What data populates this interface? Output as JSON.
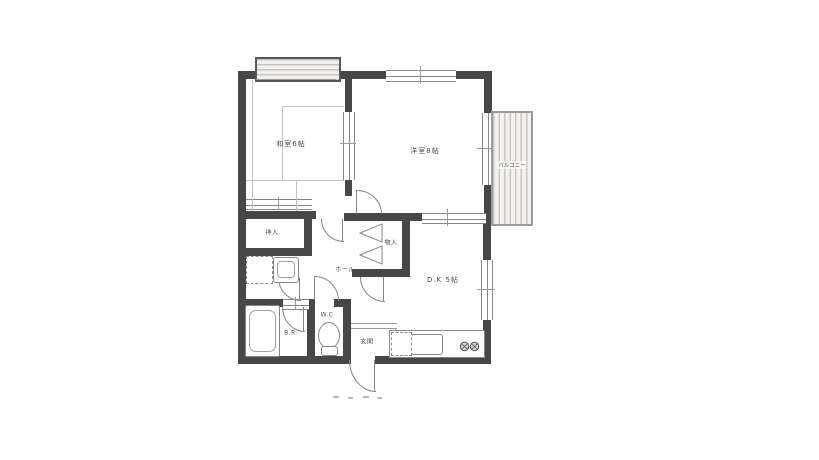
{
  "floor_plan": {
    "labels": {
      "washitsu": "和室6帖",
      "youshitsu": "洋室8帖",
      "dk": "D.K 5帖",
      "hall": "ホール",
      "oshiire": "押入",
      "monoire": "物入",
      "wc": "W.C",
      "br": "B.R",
      "genkan": "玄関",
      "balcony": "バルコニー"
    },
    "colors": {
      "wall": "#47474a",
      "line": "#85858a",
      "thin_line": "#9a9a9e",
      "background": "#ffffff",
      "hatch_dark": "#c8c7c3",
      "hatch_light": "#f2f1ee"
    }
  }
}
